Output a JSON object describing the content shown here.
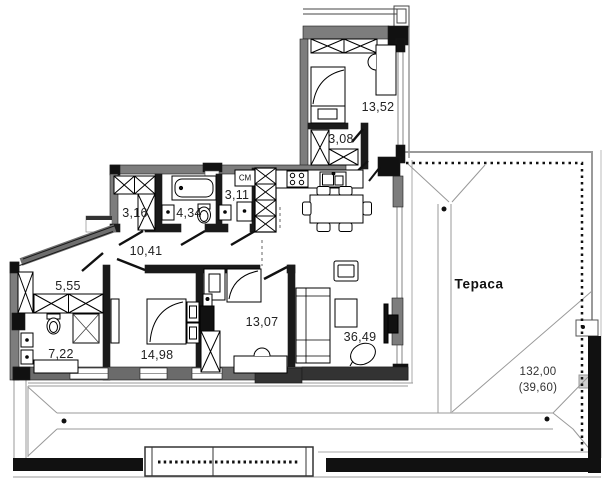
{
  "plan": {
    "rooms": [
      {
        "name": "bedroom-top",
        "area": "13,52"
      },
      {
        "name": "closet",
        "area": "3,08"
      },
      {
        "name": "wardrobe-room",
        "area": "3,16"
      },
      {
        "name": "bathroom",
        "area": "4,34"
      },
      {
        "name": "laundry",
        "area": "3,11"
      },
      {
        "name": "hallway",
        "area": "10,41"
      },
      {
        "name": "corridor",
        "area": "5,55"
      },
      {
        "name": "bathroom-2",
        "area": "7,22"
      },
      {
        "name": "bedroom-left",
        "area": "14,98"
      },
      {
        "name": "bedroom-middle",
        "area": "13,07"
      },
      {
        "name": "living-kitchen",
        "area": "36,49"
      }
    ],
    "terrace": {
      "name": "Тераса"
    },
    "roof": {
      "total_area": "132,00",
      "roof_area": "(39,60)"
    },
    "labels": {
      "washing_machine": "СМ"
    },
    "colors": {
      "wall_dark": "#1a1a1a",
      "wall_gray": "#7d7d7d",
      "roof_line": "#999999",
      "accent_black": "#111111",
      "background": "#ffffff"
    }
  }
}
